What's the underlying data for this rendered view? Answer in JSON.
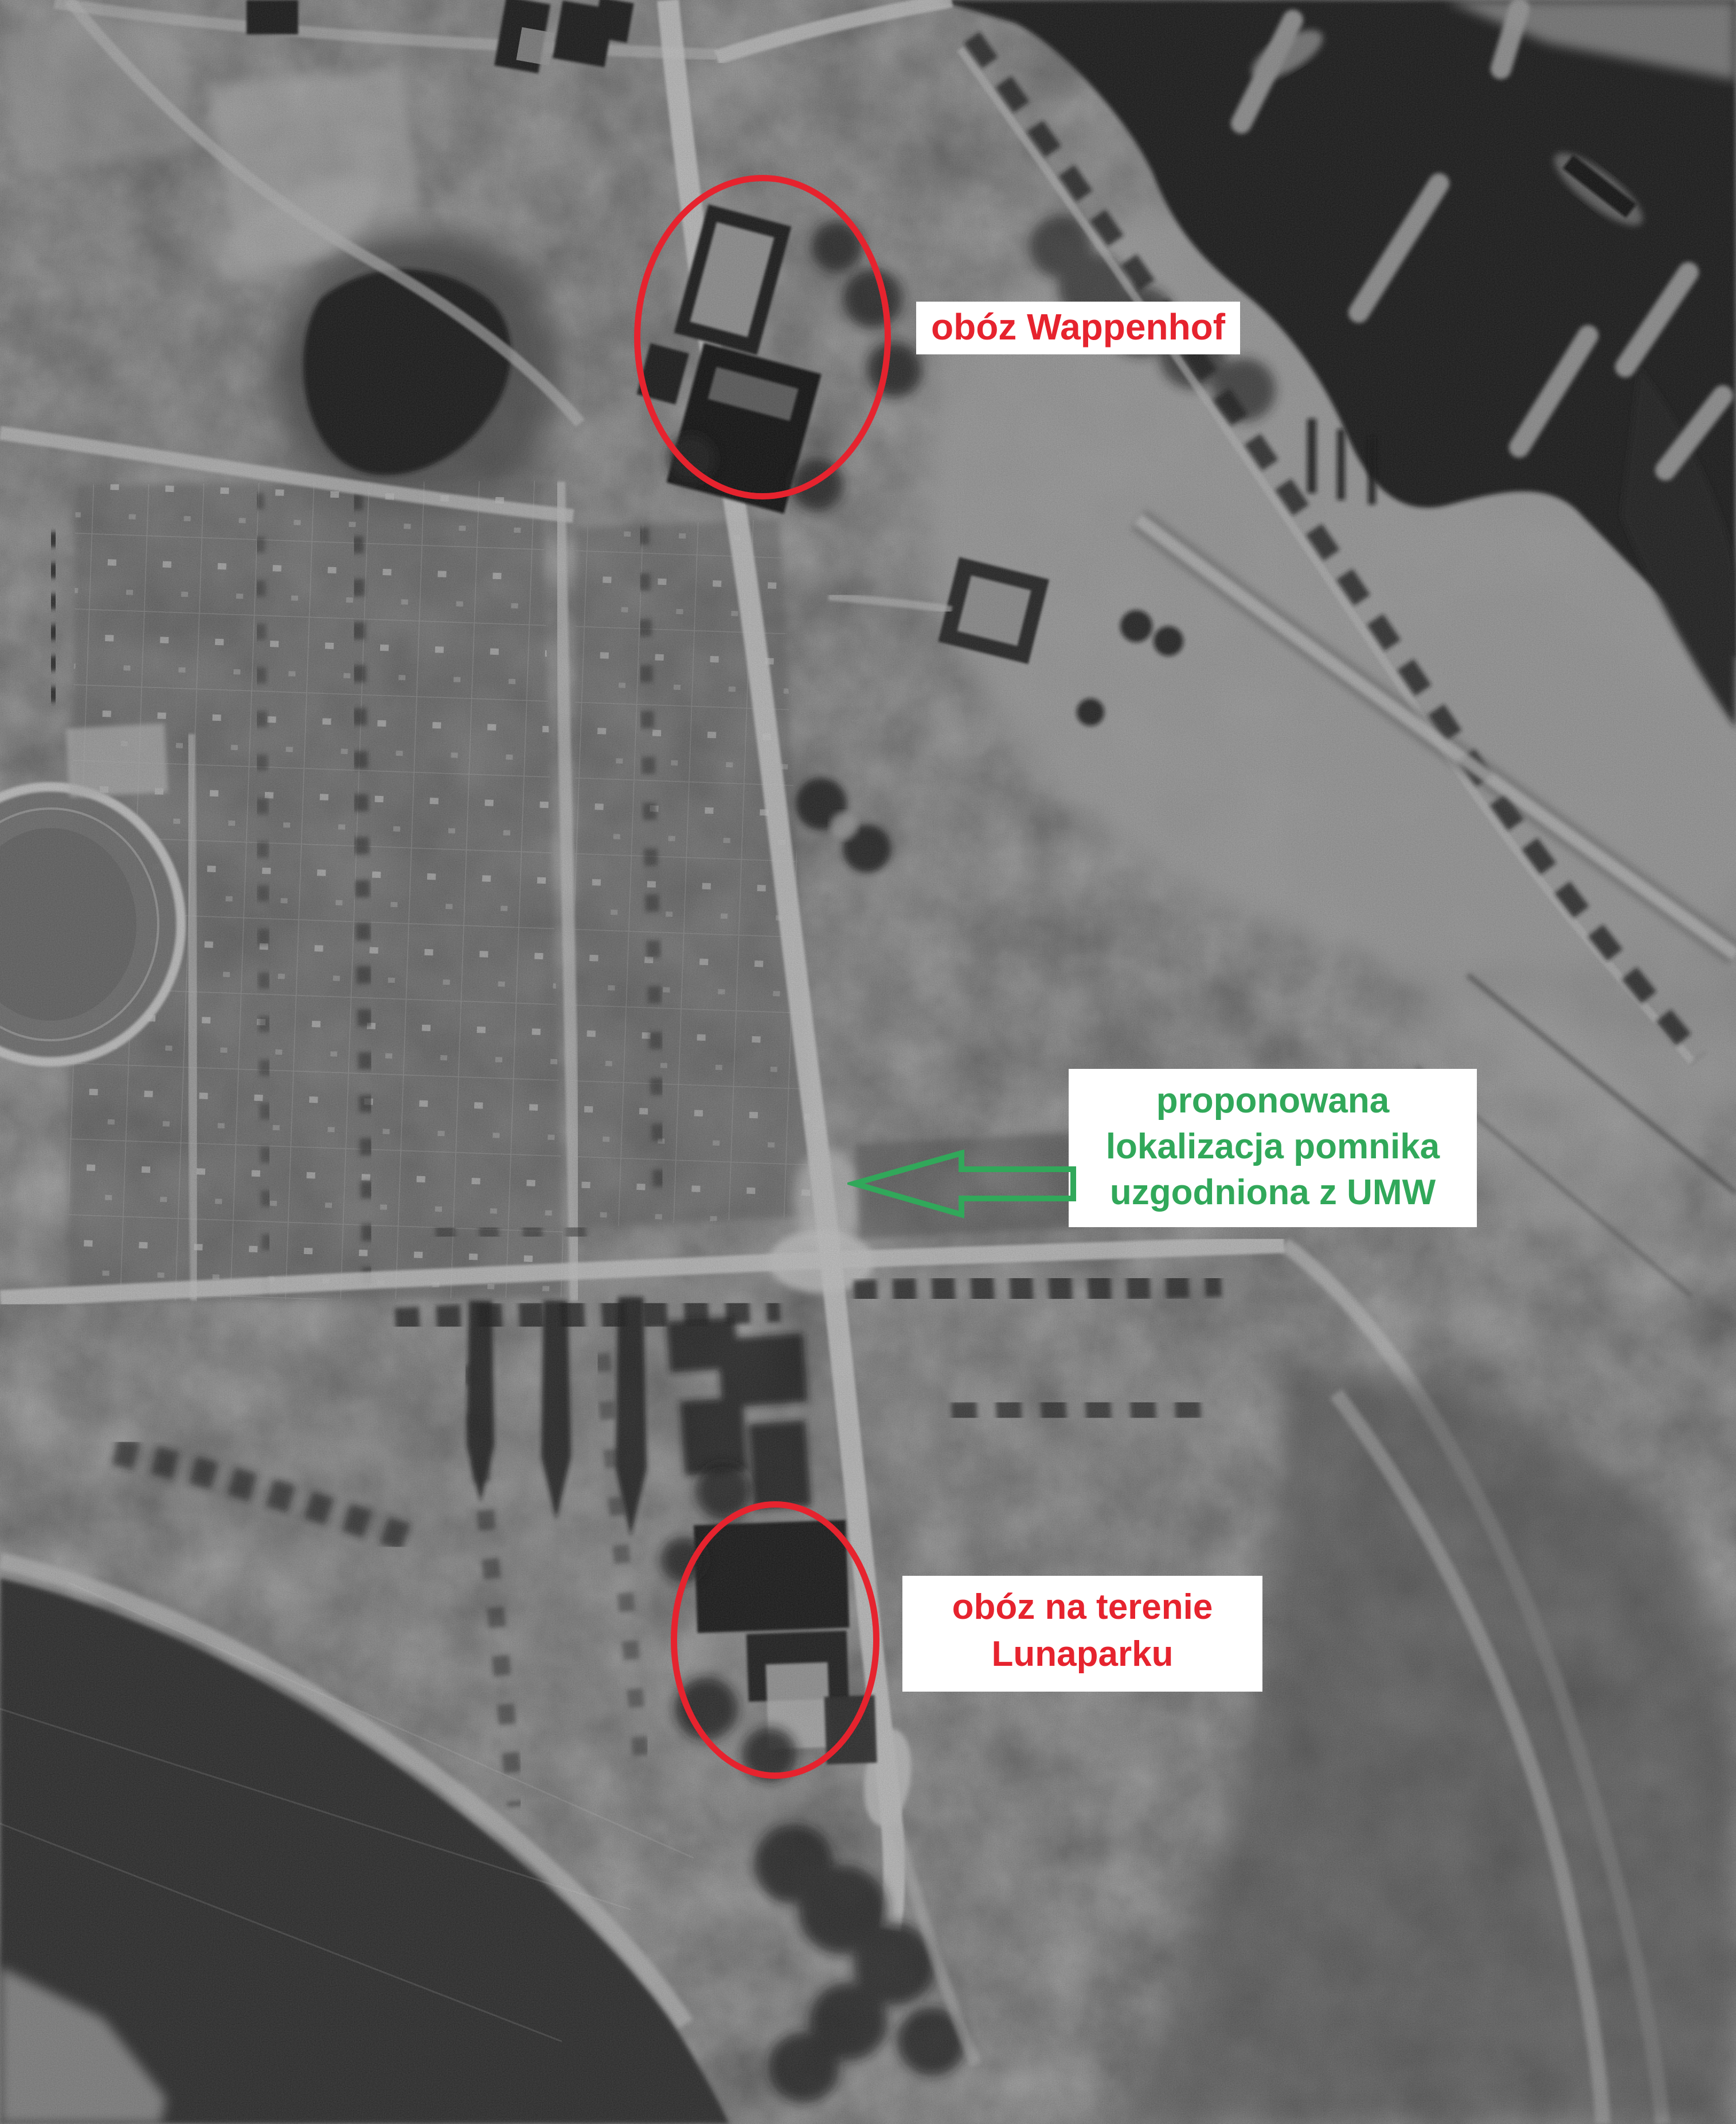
{
  "photo": {
    "description": "Black-and-white historical aerial photograph: harbor basin with breakwaters top right, allotment gardens and stadium on the left, dark lake bottom left, central road with junction, camp building complexes circled"
  },
  "colors": {
    "annotation-red": "#e6232e",
    "annotation-green": "#31a85a",
    "label-bg": "#ffffff"
  },
  "icons": {
    "monument_arrow": "left-block-arrow-outline"
  },
  "annotations": {
    "wappenhof": {
      "label": "obóz Wappenhof"
    },
    "monument": {
      "line1": "proponowana",
      "line2": "lokalizacja pomnika",
      "line3": "uzgodniona z UMW"
    },
    "lunapark": {
      "line1": "obóz na terenie",
      "line2": "Lunaparku"
    }
  }
}
